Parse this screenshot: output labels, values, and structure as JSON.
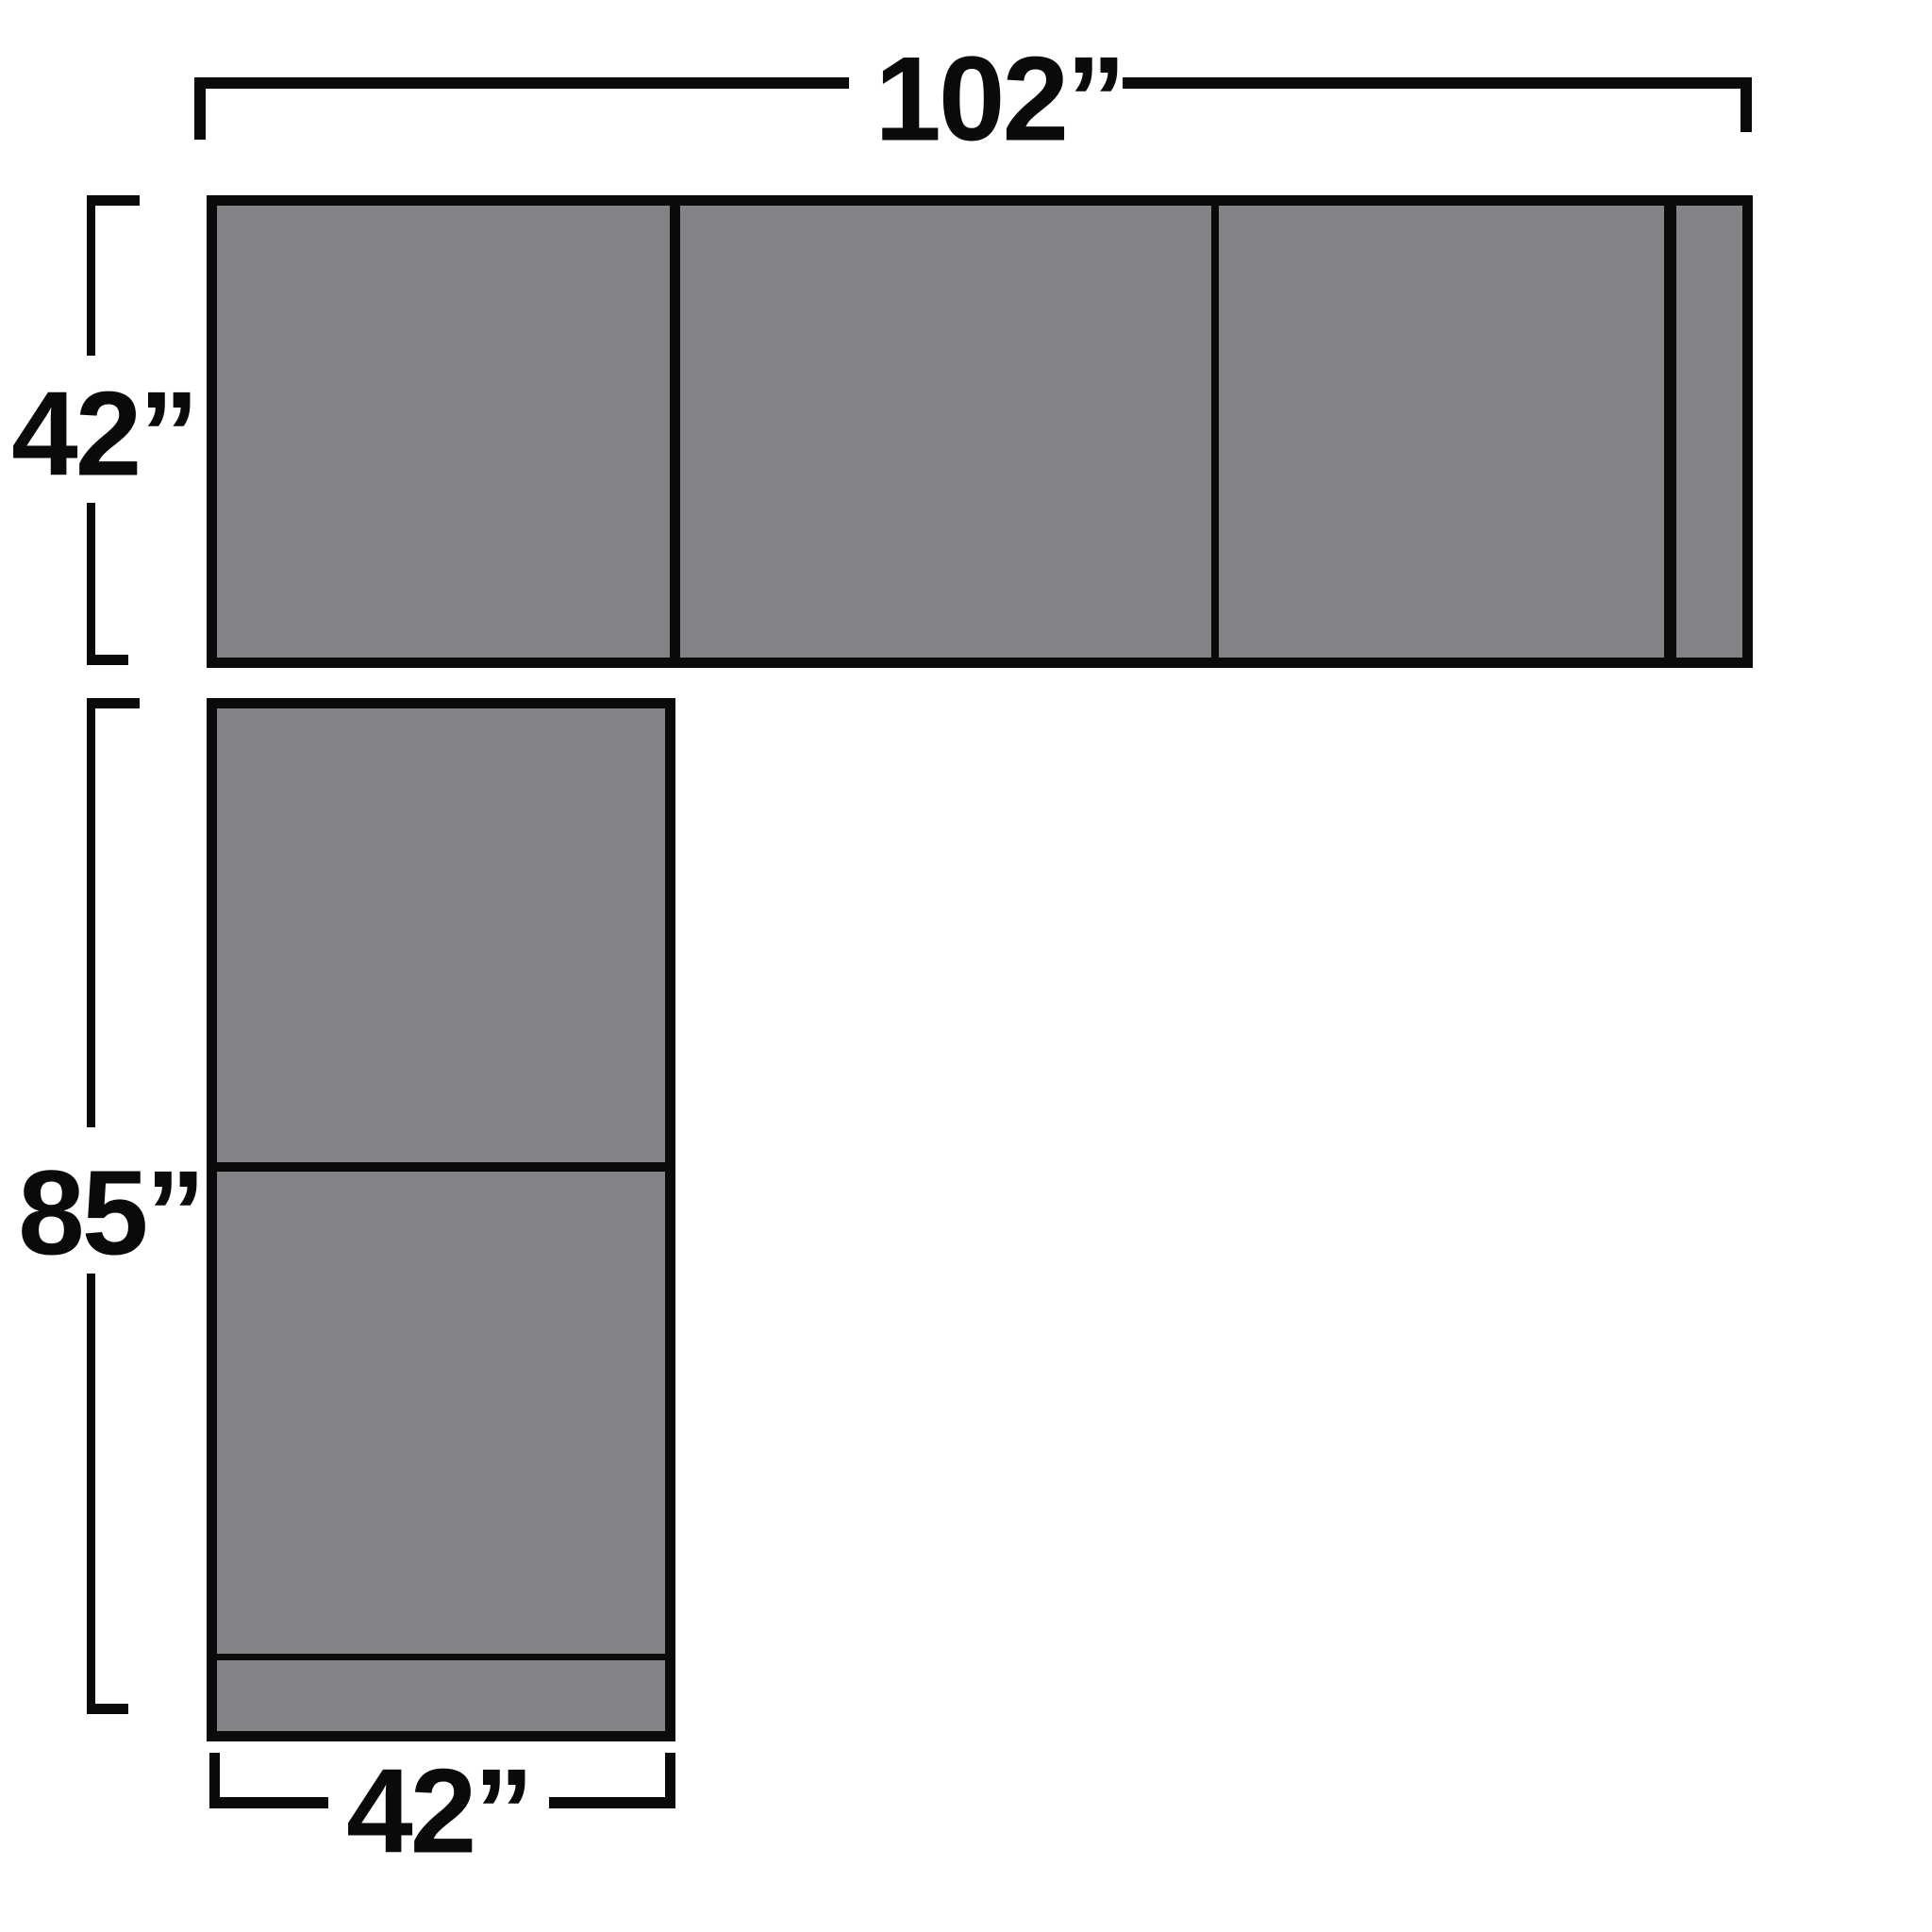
{
  "diagram": {
    "type": "sectional-sofa-dimension-diagram",
    "dimensions": {
      "top_width": "102”",
      "side_depth": "42”",
      "left_length": "85”",
      "bottom_width": "42”"
    },
    "pieces": {
      "top_row_sections": 3,
      "top_row_has_right_armrest_strip": true,
      "left_column_sections": 2,
      "left_column_has_bottom_strip": true
    },
    "colors": {
      "outline": "#0a0a0a",
      "fill": "#818387",
      "background": "#ffffff"
    }
  }
}
